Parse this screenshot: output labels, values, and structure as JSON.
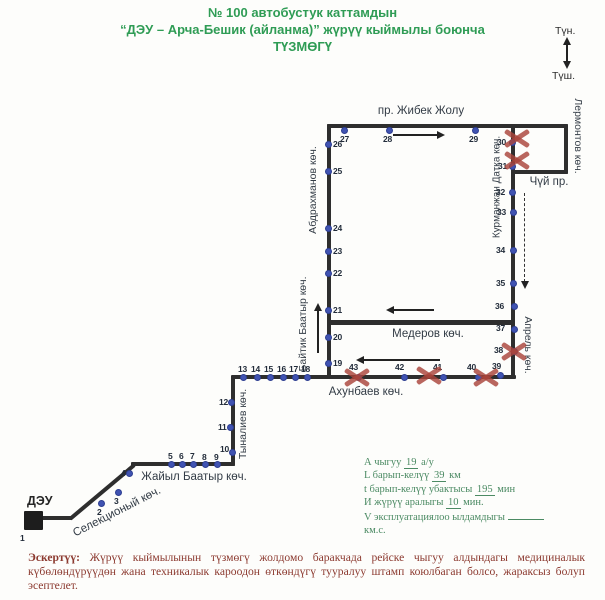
{
  "title": {
    "line1": "№ 100 автобустук каттамдын",
    "line2": "“ДЭУ – Арча-Бешик (айланма)” жүрүү кыймылы боюнча",
    "line3": "ТҮЗМӨГҮ"
  },
  "compass": {
    "north": "Түн.",
    "south": "Түш."
  },
  "terminal": {
    "label": "ДЭУ"
  },
  "colors": {
    "title_green": "#2f9c55",
    "stats_green": "#4b8a63",
    "note_red": "#8c3a30",
    "route_line": "#2e2e2e",
    "stop_blue": "#4053b2",
    "cross_red": "#aa443a"
  },
  "stats": [
    {
      "pre": "А чыгуу",
      "val": "19",
      "post": "а/у",
      "blank": false
    },
    {
      "pre": "L барып-келүү",
      "val": "39",
      "post": "км",
      "blank": false
    },
    {
      "pre": "t барып-келүү убактысы",
      "val": "195",
      "post": "мин",
      "blank": false
    },
    {
      "pre": "И жүрүү аралыгы",
      "val": "10",
      "post": "мин.",
      "blank": false
    },
    {
      "pre": "V эксплуатациялоо ылдамдыгы",
      "val": "",
      "post": "",
      "blank": true
    },
    {
      "pre": "км.с.",
      "val": "",
      "post": "",
      "blank": false
    }
  ],
  "note": {
    "bold": "Эскертүү:",
    "text": " Жүрүү кыймылынын түзмөгү жолдомо баракчада рейске чыгуу алдындагы медициналык күбөлөндүрүүдөн жана техникалык кароодон өткөндүгү тууралуу штамп коюлбаган болсо, жараксыз болуп эсептелет."
  },
  "map": {
    "segments": [
      {
        "x": 40,
        "y": 516,
        "w": 32,
        "h": 4
      },
      {
        "x": 70,
        "y": 517,
        "len": 84,
        "angle": -40
      },
      {
        "x": 131,
        "y": 462,
        "w": 104,
        "h": 4
      },
      {
        "x": 231,
        "y": 376,
        "w": 4,
        "h": 90
      },
      {
        "x": 231,
        "y": 375,
        "w": 285,
        "h": 4
      },
      {
        "x": 327,
        "y": 124,
        "w": 4,
        "h": 255
      },
      {
        "x": 327,
        "y": 124,
        "w": 241,
        "h": 4
      },
      {
        "x": 564,
        "y": 124,
        "w": 4,
        "h": 50
      },
      {
        "x": 512,
        "y": 170,
        "w": 56,
        "h": 4
      },
      {
        "x": 511,
        "y": 124,
        "w": 4,
        "h": 255
      },
      {
        "x": 329,
        "y": 320,
        "w": 184,
        "h": 5
      }
    ],
    "streets": [
      {
        "name": "пр. Жибек Жолу",
        "x": 421,
        "y": 111,
        "rot": 0,
        "size": 11.5
      },
      {
        "name": "Абдрахманов көч.",
        "x": 313,
        "y": 190,
        "rot": "up",
        "size": 10.5
      },
      {
        "name": "Байтик Баатыр көч.",
        "x": 303,
        "y": 324,
        "rot": "up",
        "size": 10.5
      },
      {
        "name": "Курманжан Датка көч.",
        "x": 497,
        "y": 187,
        "rot": "up",
        "size": 10
      },
      {
        "name": "Лермонтов көч.",
        "x": 578,
        "y": 136,
        "rot": "down",
        "size": 10.5
      },
      {
        "name": "Чүй пр.",
        "x": 549,
        "y": 182,
        "rot": 0,
        "size": 11.5
      },
      {
        "name": "Медеров көч.",
        "x": 428,
        "y": 334,
        "rot": 0,
        "size": 11.5
      },
      {
        "name": "Апрель көч.",
        "x": 528,
        "y": 345,
        "rot": "down",
        "size": 10.5
      },
      {
        "name": "Ахунбаев көч.",
        "x": 366,
        "y": 392,
        "rot": 0,
        "size": 11.5
      },
      {
        "name": "Тыналиев көч.",
        "x": 243,
        "y": 424,
        "rot": "up",
        "size": 10.5
      },
      {
        "name": "Жайыл Баатыр көч.",
        "x": 194,
        "y": 477,
        "rot": 0,
        "size": 11.5
      },
      {
        "name": "Селекционый көч.",
        "x": 117,
        "y": 512,
        "rot": -27,
        "size": 11.5
      }
    ],
    "stops": [
      {
        "n": "1",
        "dot": false,
        "lx": 20,
        "ly": 533
      },
      {
        "n": "2",
        "x": 101,
        "y": 503,
        "lx": 97,
        "ly": 507
      },
      {
        "n": "3",
        "x": 118,
        "y": 492,
        "lx": 114,
        "ly": 496
      },
      {
        "n": "4",
        "x": 129,
        "y": 473,
        "lx": 121,
        "ly": 468
      },
      {
        "n": "5",
        "x": 171,
        "y": 464,
        "lx": 168,
        "ly": 451
      },
      {
        "n": "6",
        "x": 182,
        "y": 464,
        "lx": 179,
        "ly": 451
      },
      {
        "n": "7",
        "x": 193,
        "y": 464,
        "lx": 190,
        "ly": 451
      },
      {
        "n": "8",
        "x": 205,
        "y": 464,
        "lx": 202,
        "ly": 452
      },
      {
        "n": "9",
        "x": 217,
        "y": 464,
        "lx": 214,
        "ly": 452
      },
      {
        "n": "10",
        "x": 232,
        "y": 452,
        "lx": 220,
        "ly": 444
      },
      {
        "n": "11",
        "x": 230,
        "y": 427,
        "lx": 218,
        "ly": 422
      },
      {
        "n": "12",
        "x": 231,
        "y": 402,
        "lx": 219,
        "ly": 397
      },
      {
        "n": "13",
        "x": 243,
        "y": 377,
        "lx": 238,
        "ly": 364
      },
      {
        "n": "14",
        "x": 257,
        "y": 377,
        "lx": 251,
        "ly": 364
      },
      {
        "n": "15",
        "x": 270,
        "y": 377,
        "lx": 264,
        "ly": 364
      },
      {
        "n": "16",
        "x": 283,
        "y": 377,
        "lx": 277,
        "ly": 364
      },
      {
        "n": "17",
        "x": 295,
        "y": 377,
        "lx": 289,
        "ly": 364
      },
      {
        "n": "18",
        "x": 307,
        "y": 377,
        "lx": 301,
        "ly": 364
      },
      {
        "n": "19",
        "x": 328,
        "y": 363,
        "lx": 333,
        "ly": 358
      },
      {
        "n": "20",
        "x": 328,
        "y": 337,
        "lx": 333,
        "ly": 332
      },
      {
        "n": "21",
        "x": 328,
        "y": 310,
        "lx": 333,
        "ly": 305
      },
      {
        "n": "22",
        "x": 328,
        "y": 273,
        "lx": 333,
        "ly": 268
      },
      {
        "n": "23",
        "x": 328,
        "y": 251,
        "lx": 333,
        "ly": 246
      },
      {
        "n": "24",
        "x": 328,
        "y": 228,
        "lx": 333,
        "ly": 223
      },
      {
        "n": "25",
        "x": 328,
        "y": 171,
        "lx": 333,
        "ly": 166
      },
      {
        "n": "26",
        "x": 328,
        "y": 144,
        "lx": 333,
        "ly": 139
      },
      {
        "n": "27",
        "x": 344,
        "y": 130,
        "lx": 340,
        "ly": 134
      },
      {
        "n": "28",
        "x": 389,
        "y": 130,
        "lx": 383,
        "ly": 134
      },
      {
        "n": "29",
        "x": 475,
        "y": 130,
        "lx": 469,
        "ly": 134
      },
      {
        "n": "30",
        "x": 512,
        "y": 142,
        "lx": 497,
        "ly": 137
      },
      {
        "n": "31",
        "x": 512,
        "y": 166,
        "lx": 498,
        "ly": 161
      },
      {
        "n": "32",
        "x": 512,
        "y": 192,
        "lx": 496,
        "ly": 187
      },
      {
        "n": "33",
        "x": 513,
        "y": 212,
        "lx": 497,
        "ly": 207
      },
      {
        "n": "34",
        "x": 513,
        "y": 250,
        "lx": 496,
        "ly": 245
      },
      {
        "n": "35",
        "x": 513,
        "y": 283,
        "lx": 496,
        "ly": 278
      },
      {
        "n": "36",
        "x": 514,
        "y": 306,
        "lx": 495,
        "ly": 301
      },
      {
        "n": "37",
        "x": 514,
        "y": 329,
        "lx": 496,
        "ly": 323
      },
      {
        "n": "38",
        "x": 514,
        "y": 351,
        "lx": 494,
        "ly": 345
      },
      {
        "n": "39",
        "x": 500,
        "y": 375,
        "lx": 492,
        "ly": 361
      },
      {
        "n": "40",
        "x": 478,
        "y": 377,
        "lx": 467,
        "ly": 362
      },
      {
        "n": "41",
        "x": 443,
        "y": 377,
        "lx": 433,
        "ly": 362
      },
      {
        "n": "42",
        "x": 404,
        "y": 377,
        "lx": 395,
        "ly": 362
      },
      {
        "n": "43",
        "x": 358,
        "y": 377,
        "lx": 349,
        "ly": 362
      }
    ],
    "crosses": [
      {
        "x": 517,
        "y": 138
      },
      {
        "x": 517,
        "y": 160
      },
      {
        "x": 514,
        "y": 351
      },
      {
        "x": 357,
        "y": 377
      },
      {
        "x": 429,
        "y": 375
      },
      {
        "x": 486,
        "y": 377
      }
    ],
    "arrows": [
      {
        "dir": "right",
        "x": 393,
        "y": 134,
        "len": 52
      },
      {
        "dir": "up",
        "x": 317,
        "y": 303,
        "len": 50
      },
      {
        "dir": "left",
        "x": 386,
        "y": 309,
        "len": 48
      },
      {
        "dir": "left",
        "x": 356,
        "y": 359,
        "len": 84
      },
      {
        "dir": "dashdown",
        "x": 524,
        "y": 193,
        "len": 95
      },
      {
        "dir": "updown",
        "x": 566,
        "y": 37,
        "len": 31
      }
    ]
  }
}
